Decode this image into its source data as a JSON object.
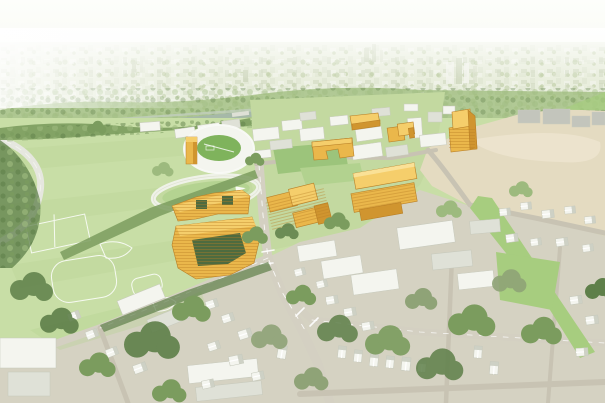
{
  "meta": {
    "title": "Aerial campus master-plan rendering",
    "description": "Bird's-eye architectural rendering of a riverside campus district. Proposed buildings are highlighted in yellow among existing white buildings, athletic fields, a horseshoe stadium, a running track, a vacant tan rail yard, a street grid and tree-lined residential neighborhoods, with a hazy city skyline and river on the horizon.",
    "visible_text": ""
  },
  "palette": {
    "sky_top": "#FDFEFB",
    "sky_horizon": "#F3F6EA",
    "city_haze": "#E7ECDA",
    "city_block_light": "#DDE3CF",
    "city_block_mid": "#CDD6BC",
    "city_green": "#B7C89C",
    "far_tree": "#9CBB7A",
    "river": "#A6B9A8",
    "river_light": "#C2CFBE",
    "bridge": "#DEE0D6",
    "field_green": "#C8DEA6",
    "field_stripe": "#BFD79C",
    "pitch_green": "#B2D28F",
    "quad_green": "#9CC47B",
    "stadium_field": "#7FB35C",
    "white_roof": "#F4F5EF",
    "white_wall": "#DFE1D7",
    "white_shadow": "#C7CABD",
    "gray_bldg": "#C3C5BC",
    "road_major": "#D4D0C2",
    "road_minor": "#C8C3B3",
    "road_line": "#FFFFFF",
    "tan_lot": "#E4DBC1",
    "tan_lot_light": "#EDE5CF",
    "yellow_top": "#F5CE6B",
    "yellow_face": "#EAB74B",
    "yellow_shadow": "#D0952F",
    "yellow_line": "#B97F26",
    "tree_dark": "#5E7F49",
    "tree_mid": "#7B9C5E",
    "tree_light": "#9DBA7E",
    "tree_gray": "#8FA377",
    "park_green": "#A7CD7F",
    "court_green": "#4E6B3F",
    "ground_neigh": "#D5D2C2",
    "campus_ground": "#C3D9A0"
  },
  "scene": {
    "landmarks": [
      "hazy city skyline on horizon",
      "river with small bridges",
      "white horseshoe stadium with green field and yellow corner tower",
      "white oval running track",
      "large playing fields with white line markings",
      "white campus building cluster",
      "proposed buildings highlighted in yellow",
      "large tan vacant rail-yard parcel",
      "street grid with crosswalks",
      "residential neighborhood of small white houses and street trees",
      "green corridor and neighborhood park"
    ]
  }
}
